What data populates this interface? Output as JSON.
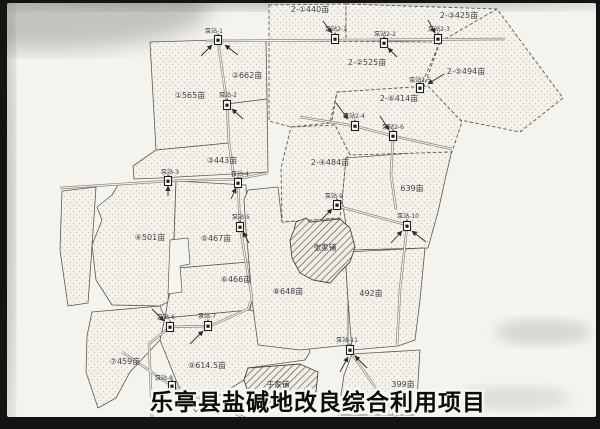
{
  "title": "乐亭县盐碱地改良综合利用项目",
  "colors": {
    "paper": "#f5f3ee",
    "ink": "#3f3c38",
    "frame": "#141413"
  },
  "parcels": [
    {
      "label": "①565亩"
    },
    {
      "label": "②662亩"
    },
    {
      "label": "③443亩"
    },
    {
      "label": "④501亩"
    },
    {
      "label": "⑤467亩"
    },
    {
      "label": "⑥466亩"
    },
    {
      "label": "⑦459亩"
    },
    {
      "label": "⑧648亩"
    },
    {
      "label": "⑨614.5亩"
    },
    {
      "label": "639亩"
    },
    {
      "label": "492亩"
    },
    {
      "label": "399亩"
    },
    {
      "label": "2-①440亩"
    },
    {
      "label": "2-②525亩"
    },
    {
      "label": "2-③425亩"
    },
    {
      "label": "2-④484亩"
    },
    {
      "label": "2-⑤494亩"
    },
    {
      "label": "2-⑥414亩"
    }
  ],
  "pumps": [
    {
      "label": "泵站-1"
    },
    {
      "label": "泵站-2"
    },
    {
      "label": "泵站-3"
    },
    {
      "label": "泵站-4"
    },
    {
      "label": "泵站-5"
    },
    {
      "label": "泵站-6"
    },
    {
      "label": "泵站-7"
    },
    {
      "label": "泵站-8"
    },
    {
      "label": "泵站-9"
    },
    {
      "label": "泵站-10"
    },
    {
      "label": "泵站-11"
    },
    {
      "label": "泵站2-1"
    },
    {
      "label": "泵站2-2"
    },
    {
      "label": "泵站2-3"
    },
    {
      "label": "泵站2-4"
    },
    {
      "label": "泵站2-5"
    },
    {
      "label": "泵站2-6"
    }
  ],
  "villages": [
    {
      "label": "张家铺"
    },
    {
      "label": "于家铺"
    }
  ]
}
